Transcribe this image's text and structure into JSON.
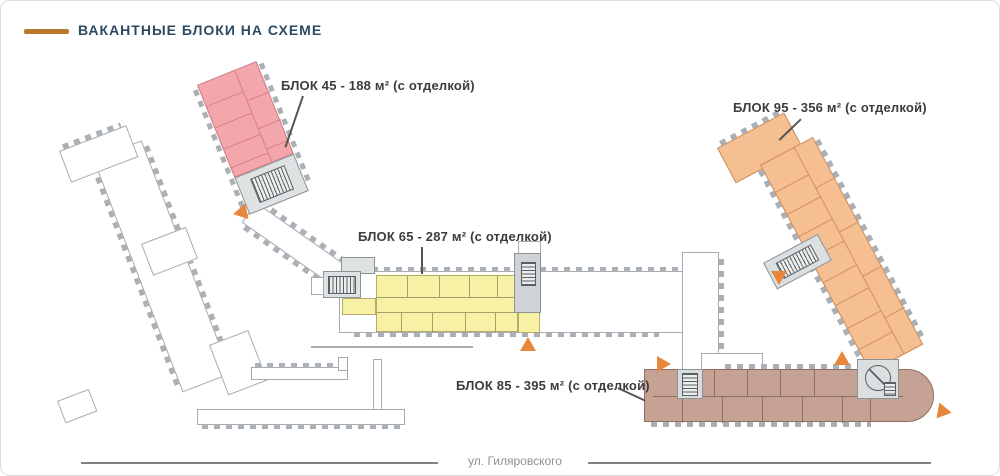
{
  "header": {
    "title": "ВАКАНТНЫЕ БЛОКИ НА СХЕМЕ"
  },
  "street": {
    "label": "ул. Гиляровского"
  },
  "blocks": {
    "b45": {
      "label": "БЛОК 45 - 188 м² (с отделкой)",
      "area_m2": 188,
      "color": "#f3a6ab"
    },
    "b65": {
      "label": "БЛОК 65 - 287 м² (с отделкой)",
      "area_m2": 287,
      "color": "#f7f1a6"
    },
    "b85": {
      "label": "БЛОК 85 - 395 м² (с отделкой)",
      "area_m2": 395,
      "color": "#c6a294"
    },
    "b95": {
      "label": "БЛОК 95 - 356 м² (с отделкой)",
      "area_m2": 356,
      "color": "#f5bf92"
    }
  },
  "colors": {
    "accent_dash": "#b9792c",
    "title_text": "#2d4a63",
    "arrow": "#e8873b"
  }
}
